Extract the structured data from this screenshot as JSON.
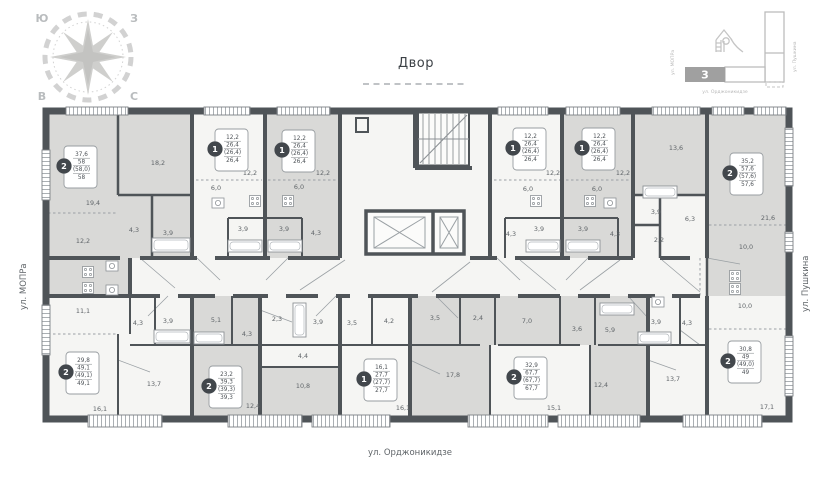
{
  "title_labels": {
    "courtyard": "Двор"
  },
  "streets": {
    "left": "ул. МОПРа",
    "right": "ул. Пушкина",
    "bottom": "ул. Орджоникидзе"
  },
  "compass": {
    "nw": "Ю",
    "ne": "З",
    "sw": "В",
    "se": "С"
  },
  "minimap": {
    "section": "3",
    "left": "ул. МОПРа",
    "right": "ул. Пушкина",
    "bottom": "ул. Орджоникидзе"
  },
  "colors": {
    "wall": "#4f5458",
    "room_gray": "#d9d9d7",
    "room_white": "#f5f5f3",
    "text": "#5f6468",
    "card_circle": "#42474c",
    "light_gray": "#c9c9c9",
    "minimap_section": "#a0a0a0"
  },
  "apartments": [
    {
      "rooms_type": "2",
      "values": [
        "37,6",
        "58",
        "(58,0)",
        "58"
      ],
      "cx": 80,
      "cy": 167
    },
    {
      "rooms_type": "1",
      "values": [
        "12,2",
        "26,4",
        "(26,4)",
        "26,4"
      ],
      "cx": 231,
      "cy": 150
    },
    {
      "rooms_type": "1",
      "values": [
        "12,2",
        "26,4",
        "(26,4)",
        "26,4"
      ],
      "cx": 298,
      "cy": 151
    },
    {
      "rooms_type": "1",
      "values": [
        "12,2",
        "26,4",
        "(26,4)",
        "26,4"
      ],
      "cx": 529,
      "cy": 149
    },
    {
      "rooms_type": "1",
      "values": [
        "12,2",
        "26,4",
        "(26,4)",
        "26,4"
      ],
      "cx": 598,
      "cy": 149
    },
    {
      "rooms_type": "2",
      "values": [
        "35,2",
        "57,6",
        "(57,6)",
        "57,6"
      ],
      "cx": 746,
      "cy": 174
    },
    {
      "rooms_type": "2",
      "values": [
        "29,8",
        "49,1",
        "(49,1)",
        "49,1"
      ],
      "cx": 82,
      "cy": 373
    },
    {
      "rooms_type": "2",
      "values": [
        "23,2",
        "39,3",
        "(39,3)",
        "39,3"
      ],
      "cx": 225,
      "cy": 387
    },
    {
      "rooms_type": "1",
      "values": [
        "16,1",
        "27,7",
        "(27,7)",
        "27,7"
      ],
      "cx": 380,
      "cy": 380
    },
    {
      "rooms_type": "2",
      "values": [
        "32,9",
        "67,7",
        "(67,7)",
        "67,7"
      ],
      "cx": 530,
      "cy": 378
    },
    {
      "rooms_type": "2",
      "values": [
        "30,8",
        "49",
        "(49,0)",
        "49"
      ],
      "cx": 744,
      "cy": 362
    }
  ],
  "rooms": [
    {
      "x": 93,
      "y": 205,
      "label": "19,4"
    },
    {
      "x": 83,
      "y": 243,
      "label": "12,2"
    },
    {
      "x": 158,
      "y": 165,
      "label": "18,2"
    },
    {
      "x": 134,
      "y": 232,
      "label": "4,3"
    },
    {
      "x": 168,
      "y": 235,
      "label": "3,9"
    },
    {
      "x": 250,
      "y": 175,
      "label": "12,2"
    },
    {
      "x": 216,
      "y": 190,
      "label": "6,0"
    },
    {
      "x": 243,
      "y": 231,
      "label": "3,9"
    },
    {
      "x": 323,
      "y": 175,
      "label": "12,2"
    },
    {
      "x": 299,
      "y": 189,
      "label": "6,0"
    },
    {
      "x": 284,
      "y": 231,
      "label": "3,9"
    },
    {
      "x": 316,
      "y": 235,
      "label": "4,3"
    },
    {
      "x": 553,
      "y": 175,
      "label": "12,2"
    },
    {
      "x": 528,
      "y": 191,
      "label": "6,0"
    },
    {
      "x": 539,
      "y": 231,
      "label": "3,9"
    },
    {
      "x": 511,
      "y": 236,
      "label": "4,3"
    },
    {
      "x": 623,
      "y": 175,
      "label": "12,2"
    },
    {
      "x": 597,
      "y": 191,
      "label": "6,0"
    },
    {
      "x": 583,
      "y": 231,
      "label": "3,9"
    },
    {
      "x": 615,
      "y": 236,
      "label": "4,3"
    },
    {
      "x": 656,
      "y": 214,
      "label": "3,9"
    },
    {
      "x": 659,
      "y": 242,
      "label": "2,2"
    },
    {
      "x": 676,
      "y": 150,
      "label": "13,6"
    },
    {
      "x": 690,
      "y": 221,
      "label": "6,3"
    },
    {
      "x": 768,
      "y": 220,
      "label": "21,6"
    },
    {
      "x": 746,
      "y": 249,
      "label": "10,0"
    },
    {
      "x": 83,
      "y": 313,
      "label": "11,1"
    },
    {
      "x": 138,
      "y": 325,
      "label": "4,3"
    },
    {
      "x": 168,
      "y": 323,
      "label": "3,9"
    },
    {
      "x": 216,
      "y": 322,
      "label": "5,1"
    },
    {
      "x": 247,
      "y": 336,
      "label": "4,3"
    },
    {
      "x": 277,
      "y": 321,
      "label": "2,3"
    },
    {
      "x": 318,
      "y": 324,
      "label": "3,9"
    },
    {
      "x": 352,
      "y": 325,
      "label": "3,5"
    },
    {
      "x": 389,
      "y": 323,
      "label": "4,2"
    },
    {
      "x": 435,
      "y": 320,
      "label": "3,5"
    },
    {
      "x": 478,
      "y": 320,
      "label": "2,4"
    },
    {
      "x": 527,
      "y": 323,
      "label": "7,0"
    },
    {
      "x": 577,
      "y": 331,
      "label": "3,6"
    },
    {
      "x": 610,
      "y": 332,
      "label": "5,9"
    },
    {
      "x": 656,
      "y": 324,
      "label": "3,9"
    },
    {
      "x": 687,
      "y": 325,
      "label": "4,3"
    },
    {
      "x": 745,
      "y": 308,
      "label": "10,0"
    },
    {
      "x": 303,
      "y": 358,
      "label": "4,4"
    },
    {
      "x": 303,
      "y": 388,
      "label": "10,8"
    },
    {
      "x": 154,
      "y": 386,
      "label": "13,7"
    },
    {
      "x": 100,
      "y": 411,
      "label": "16,1"
    },
    {
      "x": 253,
      "y": 408,
      "label": "12,4"
    },
    {
      "x": 403,
      "y": 410,
      "label": "16,1"
    },
    {
      "x": 453,
      "y": 377,
      "label": "17,8"
    },
    {
      "x": 554,
      "y": 410,
      "label": "15,1"
    },
    {
      "x": 601,
      "y": 387,
      "label": "12,4"
    },
    {
      "x": 673,
      "y": 381,
      "label": "13,7"
    },
    {
      "x": 767,
      "y": 409,
      "label": "17,1"
    }
  ]
}
